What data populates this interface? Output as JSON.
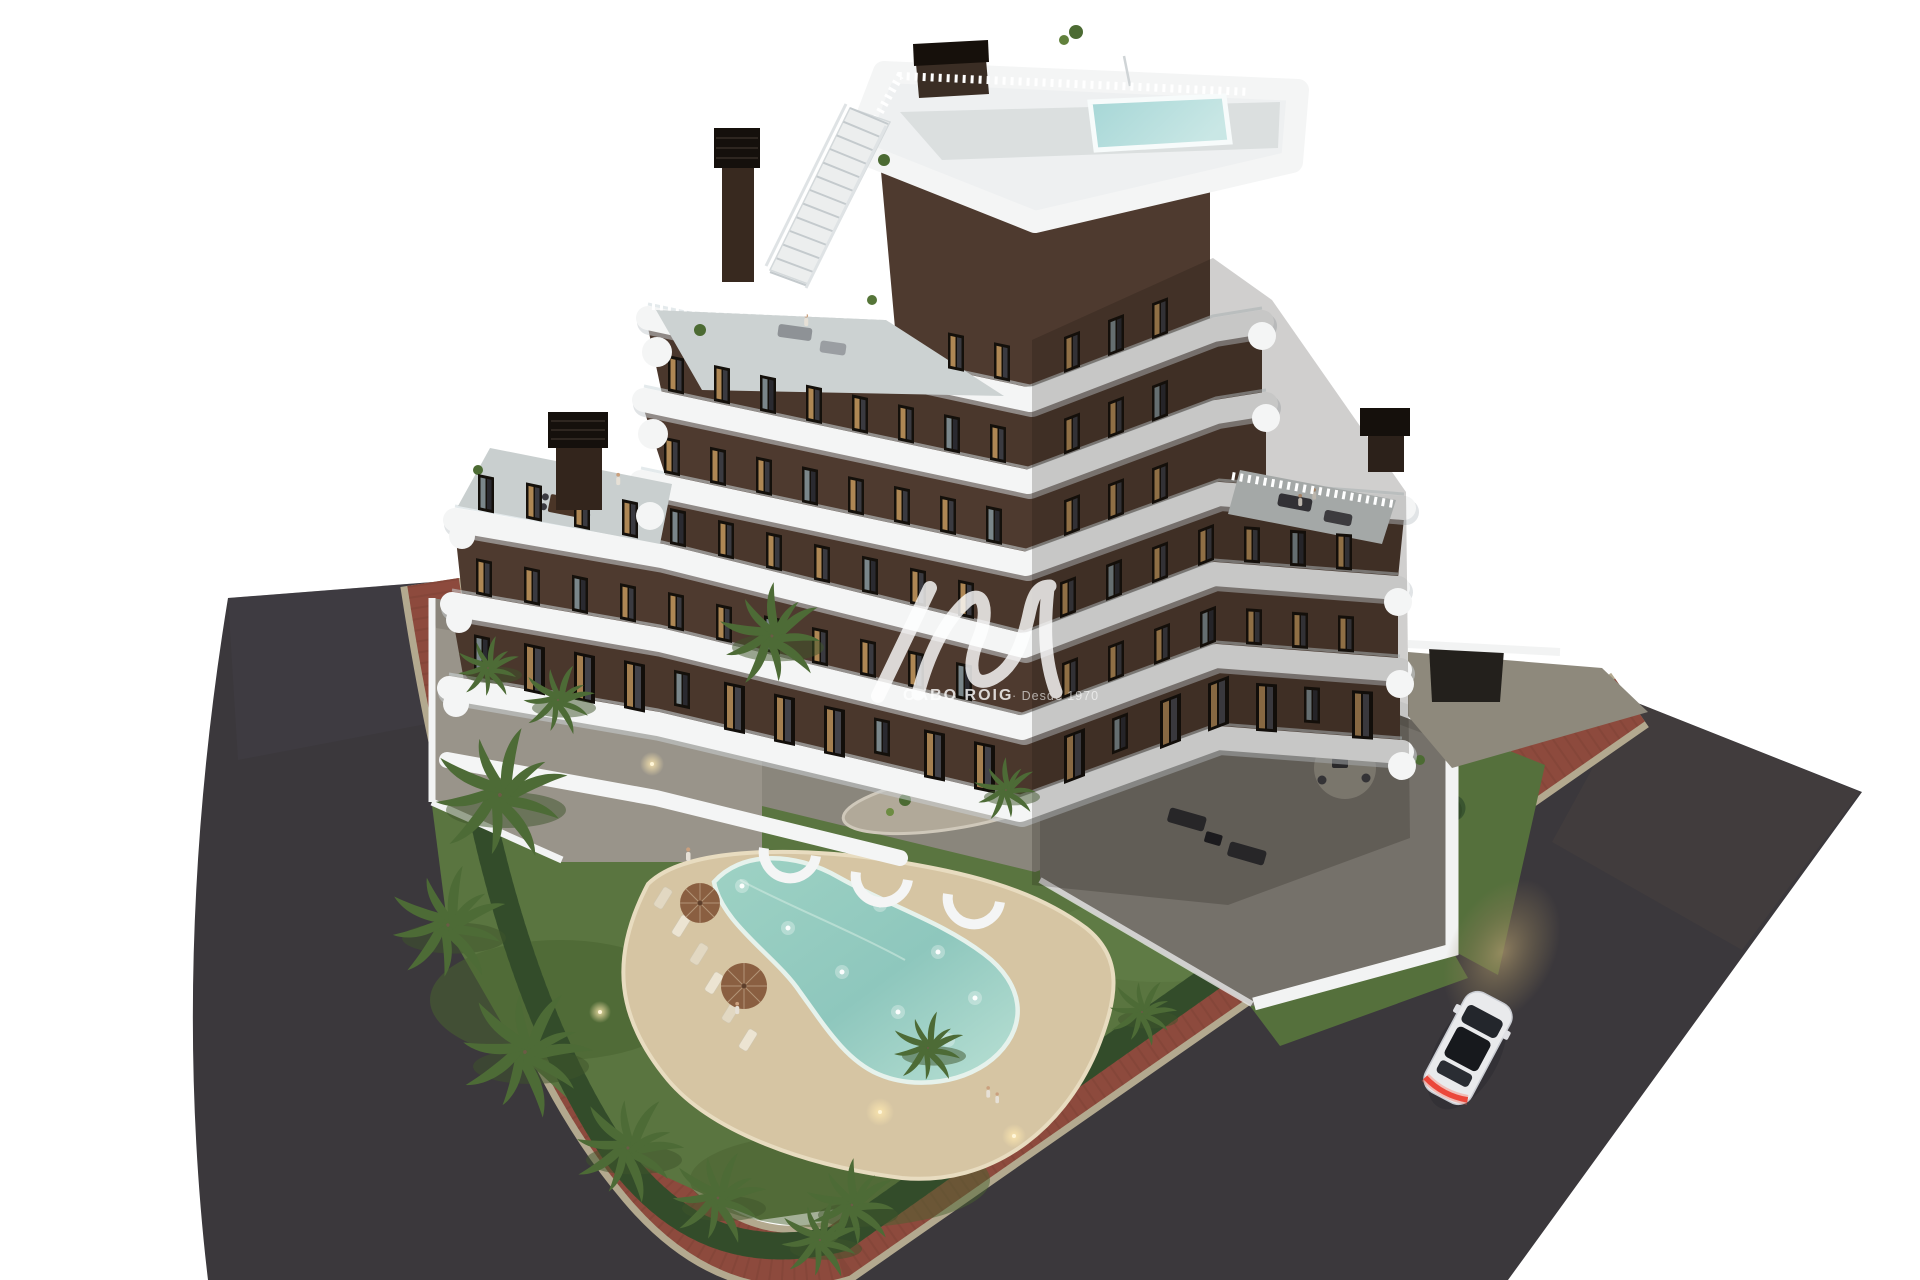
{
  "meta": {
    "type": "architectural-3d-render",
    "description": "Aerial dusk view of a modern seven-storey apartment residence with curved white balcony bands and dark brown facades, rooftop plunge pool, landscaped garden with lagoon-style pool, palm trees, red-brick sidewalks, asphalt streets and a white car driving by.",
    "time_of_day": "dusk"
  },
  "watermark": {
    "brand": "CABO ROIG",
    "tagline": "· Desde 1970"
  },
  "palette": {
    "background": "#ffffff",
    "asphalt": "#3b383c",
    "sidewalk_brick": "#8d4a3d",
    "curb": "#b3a98f",
    "facade_brown": "#4e3a2f",
    "facade_brown_shadow": "#362920",
    "balcony_white": "#f4f5f5",
    "lawn_green": "#5a7540",
    "hedge_green": "#3a5530",
    "pool_turquoise": "#8ec7bd",
    "deck_sand": "#d6c5a3",
    "window_glow": "#c99c62",
    "car_white": "#e9eaec",
    "taillight_red": "#d6392f"
  },
  "scene": {
    "building": {
      "floors_visible": 7,
      "style": "curved white balcony ribbons, dark brown walls, glass railings",
      "rooftop": [
        "roof terrace",
        "plunge pool",
        "access staircase",
        "chimneys"
      ]
    },
    "grounds": [
      "lagoon pool with underwater lights",
      "sun loungers",
      "parasols",
      "palm trees",
      "lawn",
      "perimeter hedge",
      "rock garden island",
      "ground-floor terraces with dining sets"
    ],
    "streets": [
      "asphalt road left",
      "asphalt road right",
      "red brick sidewalk",
      "white car with taillights lit"
    ]
  }
}
